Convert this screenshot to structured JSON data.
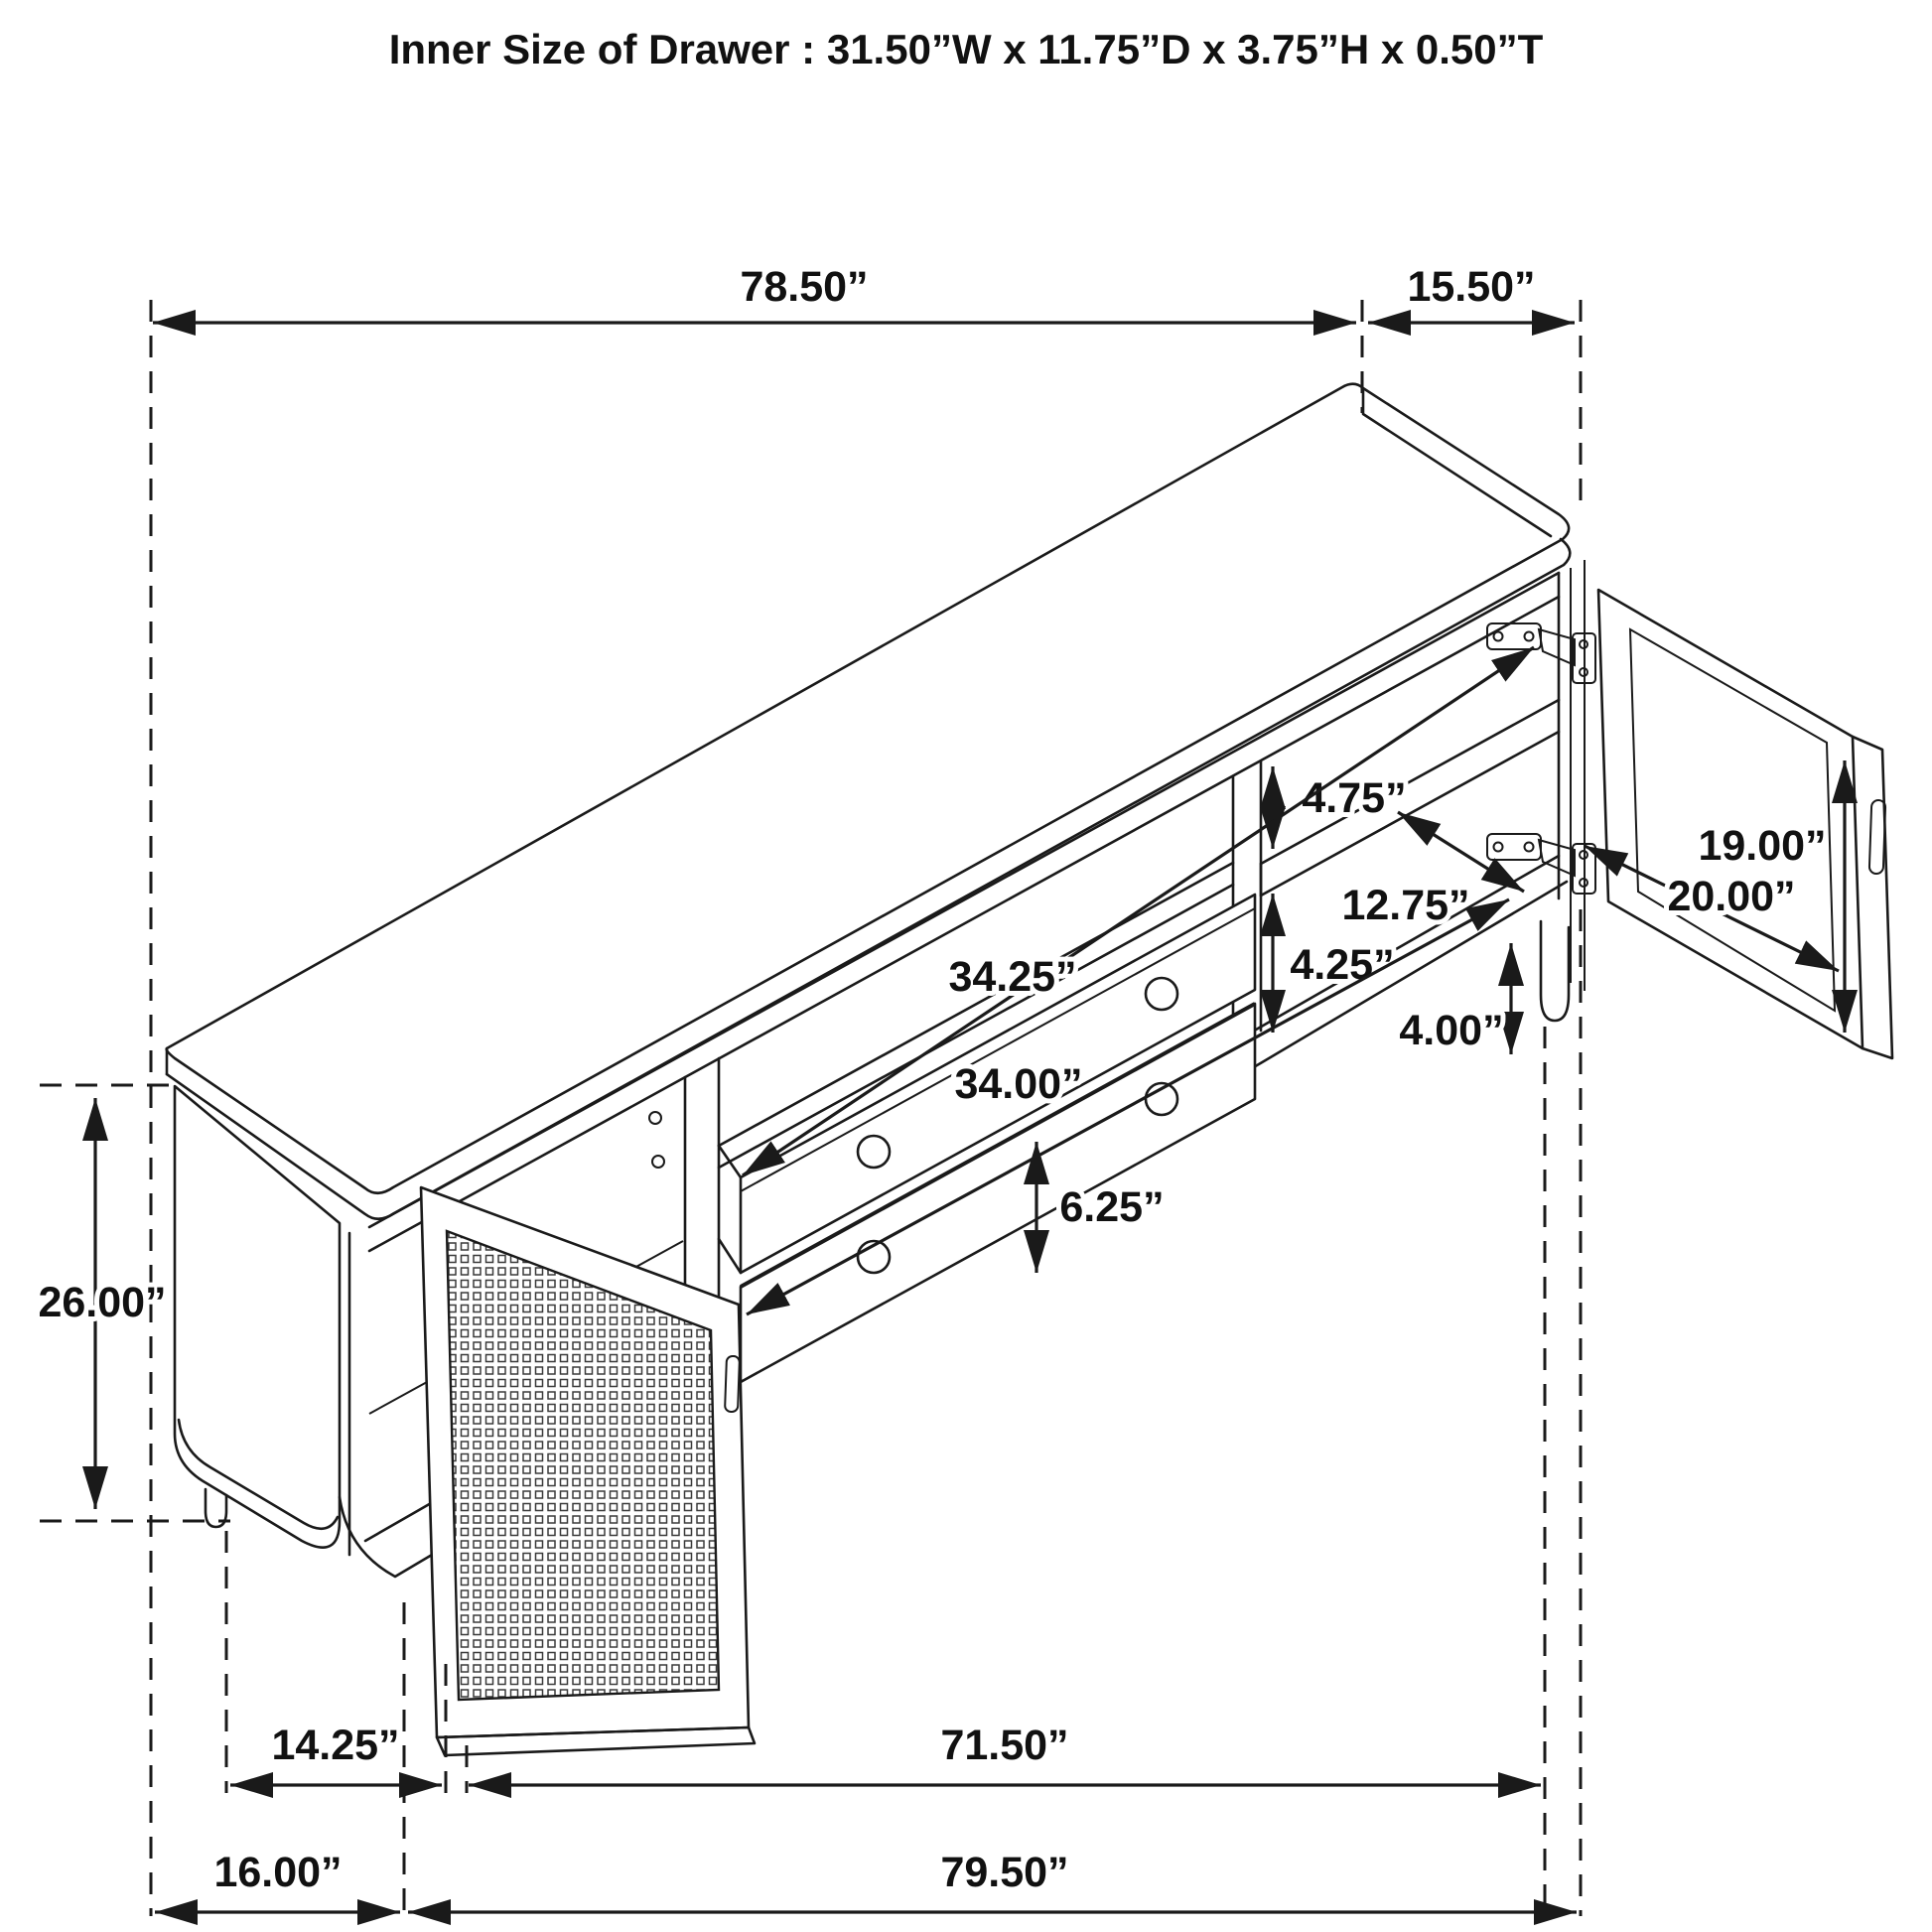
{
  "title": "Inner Size of Drawer : 31.50”W x 11.75”D x 3.75”H x 0.50”T",
  "unit": "inches",
  "dimensions": {
    "top_width": {
      "label": "78.50”",
      "value": 78.5
    },
    "top_depth": {
      "label": "15.50”",
      "value": 15.5
    },
    "upper_shelf_clearance": {
      "label": "4.75”",
      "value": 4.75
    },
    "shelf_depth": {
      "label": "12.75”",
      "value": 12.75
    },
    "door_height": {
      "label": "19.00”",
      "value": 19.0
    },
    "door_width": {
      "label": "20.00”",
      "value": 20.0
    },
    "upper_drawer_width": {
      "label": "34.25”",
      "value": 34.25
    },
    "lower_shelf_clearance": {
      "label": "4.25”",
      "value": 4.25
    },
    "lower_drawer_width": {
      "label": "34.00”",
      "value": 34.0
    },
    "leg_height": {
      "label": "4.00”",
      "value": 4.0
    },
    "drawer_front_height": {
      "label": "6.25”",
      "value": 6.25
    },
    "cabinet_height": {
      "label": "26.00”",
      "value": 26.0
    },
    "leg_span_side": {
      "label": "14.25”",
      "value": 14.25
    },
    "base_span_front": {
      "label": "71.50”",
      "value": 71.5
    },
    "overall_depth": {
      "label": "16.00”",
      "value": 16.0
    },
    "overall_width_base": {
      "label": "79.50”",
      "value": 79.5
    }
  }
}
